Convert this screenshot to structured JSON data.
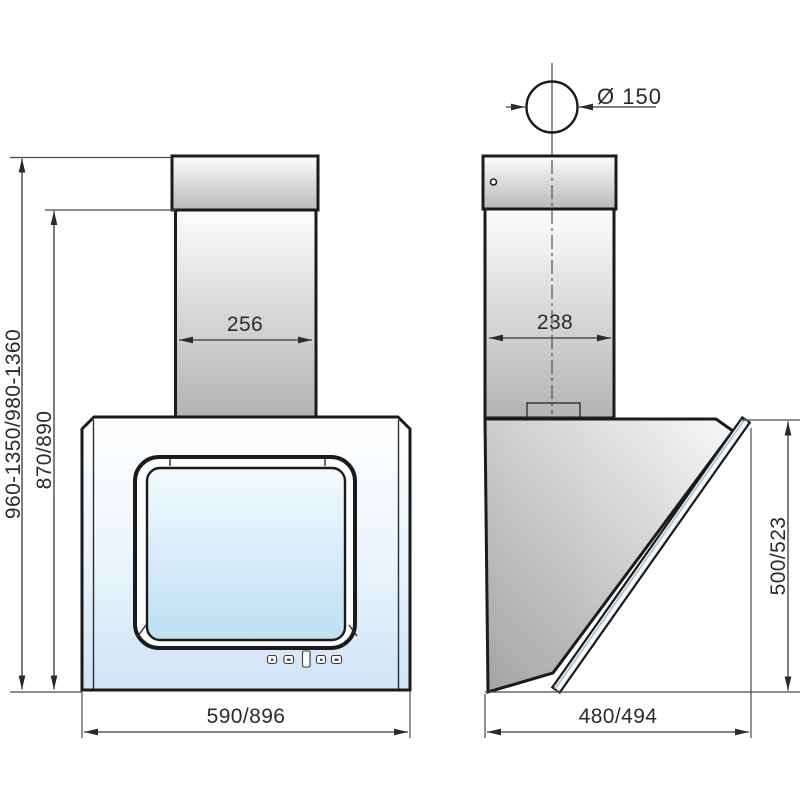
{
  "drawing": {
    "front_view": {
      "total_height_range": "960-1350/980-1360",
      "body_height": "870/890",
      "chimney_width": "256",
      "body_width": "590/896"
    },
    "side_view": {
      "duct_diameter": "Ø 150",
      "chimney_depth": "238",
      "glass_panel_length": "500/523",
      "body_depth": "480/494"
    },
    "colors": {
      "outline": "#1b1b1b",
      "dimension_lines": "#4a4a4a",
      "steel_light": "#fbfbfb",
      "steel_dark": "#b5b5b5",
      "glass_top": "#f3faff",
      "glass_bottom": "#bedff3"
    }
  }
}
